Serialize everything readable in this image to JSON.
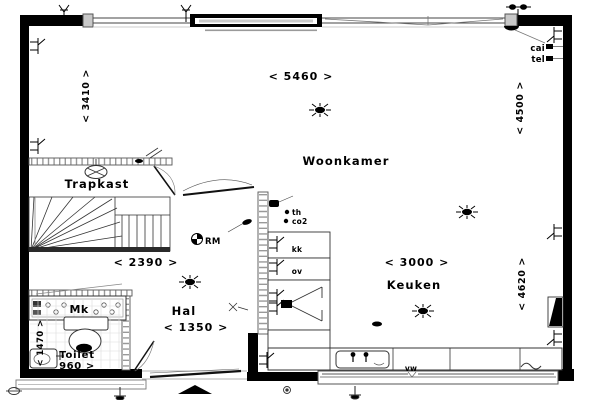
{
  "plan": {
    "rooms": {
      "woonkamer": "Woonkamer",
      "keuken": "Keuken",
      "trapkast": "Trapkast",
      "hal": "Hal",
      "toilet": "Toilet",
      "meterkast": "Mk"
    },
    "dimensions": {
      "total_width": "< 5460 >",
      "left_height": "< 3410 >",
      "right_upper_height": "< 4500 >",
      "right_lower_height": "< 4620 >",
      "stairs_width": "< 2390 >",
      "kitchen_width": "< 3000 >",
      "hall_width": "< 1350 >",
      "toilet_width": "960 >",
      "toilet_depth": "< 1470 >"
    },
    "annotations": {
      "smoke_detector": "RM",
      "thermostat": "th",
      "co2_sensor": "co2",
      "fridge": "kk",
      "oven": "ov",
      "dishwasher": "vw",
      "cable_outlet": "cai",
      "telephone_outlet": "tel"
    },
    "colors": {
      "wall": "#000000",
      "line": "#333333",
      "thin_line": "#999999",
      "background": "#ffffff"
    }
  }
}
